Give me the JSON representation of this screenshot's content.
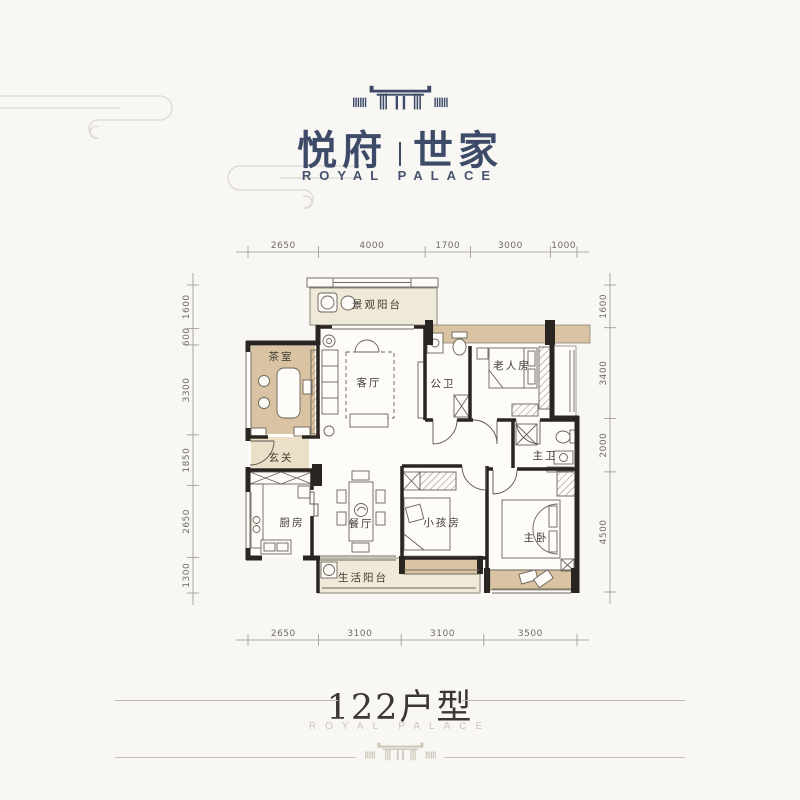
{
  "header": {
    "brand_left": "悦府",
    "brand_right": "世家",
    "subtitle": "ROYAL PALACE"
  },
  "floorplan": {
    "dimensions": {
      "top": [
        "2650",
        "4000",
        "1700",
        "3000",
        "1000"
      ],
      "bottom": [
        "2650",
        "3100",
        "3100",
        "3500"
      ],
      "left": [
        "1600",
        "600",
        "3300",
        "1850",
        "2650",
        "1300"
      ],
      "right": [
        "1600",
        "3400",
        "2000",
        "4500"
      ]
    },
    "rooms": [
      {
        "id": "view-balcony",
        "label": "景观阳台"
      },
      {
        "id": "tea-room",
        "label": "茶室"
      },
      {
        "id": "living-room",
        "label": "客厅"
      },
      {
        "id": "public-bath",
        "label": "公卫"
      },
      {
        "id": "elder-room",
        "label": "老人房"
      },
      {
        "id": "foyer",
        "label": "玄关"
      },
      {
        "id": "master-bath",
        "label": "主卫"
      },
      {
        "id": "kitchen",
        "label": "厨房"
      },
      {
        "id": "dining-room",
        "label": "餐厅"
      },
      {
        "id": "kids-room",
        "label": "小孩房"
      },
      {
        "id": "master-bedroom",
        "label": "主卧"
      },
      {
        "id": "service-balcony",
        "label": "生活阳台"
      }
    ],
    "colors": {
      "wall": "#2b2522",
      "room_beige": "#d9c3a3",
      "room_cream": "#efe9d8",
      "accent_navy": "#3d4b68"
    }
  },
  "footer": {
    "title": "122户型",
    "subtitle": "ROYAL PALACE"
  }
}
